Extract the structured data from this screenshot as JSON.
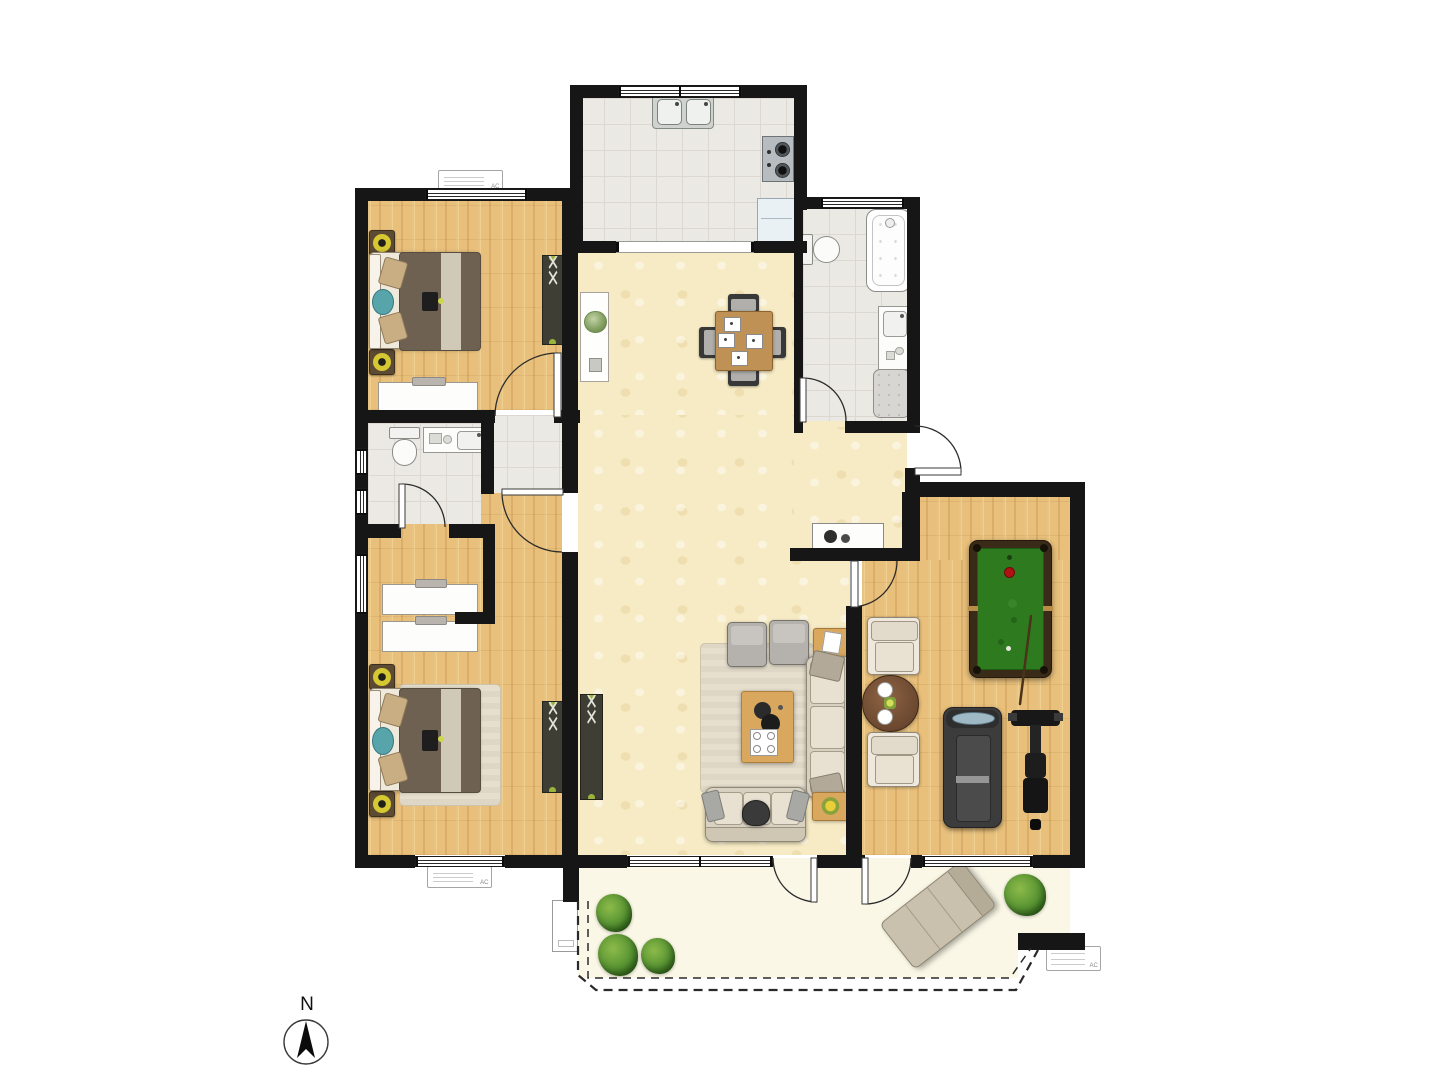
{
  "meta": {
    "title": "apartment-floor-plan",
    "ac_label": "AC"
  },
  "compass": {
    "label": "N",
    "cx": 306,
    "cy": 1042,
    "r": 22,
    "arrow": "306,1021 315,1058 306,1049 297,1058"
  },
  "palette": {
    "wall": "#161616",
    "wood": "#e9c07b",
    "tile": "#ebe9e4",
    "tileline": "#dcd8d1",
    "hall": "#f6ebc4",
    "balcony": "#faf7e6",
    "felt": "#2e7b1f",
    "plant_green": "#569331",
    "accent_teal": "#57a4ab",
    "lamp_yellow": "#d6c832"
  },
  "rooms": [
    {
      "name": "kitchen"
    },
    {
      "name": "bathroom-main"
    },
    {
      "name": "bedroom-guest"
    },
    {
      "name": "bathroom-small"
    },
    {
      "name": "bedroom-master"
    },
    {
      "name": "dining-living-hall"
    },
    {
      "name": "recreation-room"
    },
    {
      "name": "balcony"
    }
  ],
  "floors": [
    {
      "n": "balcony-floor",
      "c": "balcony",
      "x": 578,
      "y": 858,
      "w": 492,
      "h": 78
    },
    {
      "n": "balcony-floor",
      "c": "balcony",
      "x": 578,
      "y": 858,
      "w": 440,
      "h": 120
    },
    {
      "n": "dining-floor",
      "c": "hall",
      "x": 578,
      "y": 247,
      "w": 216,
      "h": 180
    },
    {
      "n": "hall-floor",
      "c": "hall",
      "x": 578,
      "y": 415,
      "w": 272,
      "h": 440
    },
    {
      "n": "entry-floor",
      "c": "hall",
      "x": 794,
      "y": 427,
      "w": 113,
      "h": 121
    },
    {
      "n": "bedroom-guest-floor",
      "c": "wood",
      "x": 368,
      "y": 201,
      "w": 194,
      "h": 209
    },
    {
      "n": "bedroom-master-floor",
      "c": "wood",
      "x": 368,
      "y": 490,
      "w": 194,
      "h": 365
    },
    {
      "n": "rec-room-floor",
      "c": "wood",
      "x": 915,
      "y": 495,
      "w": 155,
      "h": 75
    },
    {
      "n": "rec-room-floor",
      "c": "wood",
      "x": 862,
      "y": 560,
      "w": 208,
      "h": 295
    },
    {
      "n": "kitchen-floor",
      "c": "tile",
      "x": 578,
      "y": 98,
      "w": 216,
      "h": 143
    },
    {
      "n": "bathroom-floor",
      "c": "tile",
      "x": 803,
      "y": 208,
      "w": 104,
      "h": 213
    },
    {
      "n": "small-bath-floor",
      "c": "tile",
      "x": 368,
      "y": 423,
      "w": 113,
      "h": 101
    },
    {
      "n": "vestibule-floor",
      "c": "tile",
      "x": 481,
      "y": 415,
      "w": 81,
      "h": 78
    }
  ],
  "walls": [
    [
      570,
      85,
      237,
      13
    ],
    [
      570,
      85,
      13,
      168
    ],
    [
      794,
      85,
      13,
      125
    ],
    [
      794,
      197,
      126,
      12
    ],
    [
      907,
      197,
      13,
      236
    ],
    [
      794,
      209,
      9,
      224
    ],
    [
      845,
      421,
      75,
      12
    ],
    [
      570,
      241,
      46,
      12
    ],
    [
      754,
      241,
      53,
      12
    ],
    [
      355,
      188,
      216,
      13
    ],
    [
      355,
      188,
      13,
      680
    ],
    [
      355,
      410,
      140,
      13
    ],
    [
      562,
      188,
      16,
      305
    ],
    [
      554,
      410,
      26,
      13
    ],
    [
      481,
      410,
      13,
      84
    ],
    [
      355,
      524,
      46,
      14
    ],
    [
      449,
      524,
      46,
      14
    ],
    [
      483,
      538,
      12,
      86
    ],
    [
      455,
      612,
      40,
      12
    ],
    [
      562,
      552,
      16,
      306
    ],
    [
      790,
      548,
      125,
      13
    ],
    [
      902,
      492,
      18,
      69
    ],
    [
      846,
      606,
      16,
      252
    ],
    [
      906,
      482,
      179,
      15
    ],
    [
      905,
      468,
      15,
      28
    ],
    [
      1070,
      482,
      15,
      386
    ],
    [
      355,
      855,
      60,
      13
    ],
    [
      505,
      855,
      58,
      13
    ],
    [
      563,
      855,
      16,
      47
    ],
    [
      563,
      855,
      64,
      13
    ],
    [
      817,
      855,
      48,
      13
    ],
    [
      911,
      855,
      11,
      13
    ],
    [
      1033,
      855,
      52,
      13
    ],
    [
      1018,
      933,
      67,
      17
    ]
  ],
  "windows": [
    {
      "x": 618,
      "y": 86,
      "w": 124,
      "h": 11,
      "o": "h"
    },
    {
      "x": 820,
      "y": 198,
      "w": 85,
      "h": 10,
      "o": "h"
    },
    {
      "x": 425,
      "y": 189,
      "w": 103,
      "h": 11,
      "o": "h"
    },
    {
      "x": 356,
      "y": 448,
      "w": 11,
      "h": 28,
      "o": "v"
    },
    {
      "x": 356,
      "y": 488,
      "w": 11,
      "h": 28,
      "o": "v"
    },
    {
      "x": 356,
      "y": 553,
      "w": 11,
      "h": 62,
      "o": "v"
    },
    {
      "x": 415,
      "y": 856,
      "w": 90,
      "h": 11,
      "o": "h"
    },
    {
      "x": 627,
      "y": 856,
      "w": 146,
      "h": 11,
      "o": "h"
    },
    {
      "x": 922,
      "y": 856,
      "w": 111,
      "h": 11,
      "o": "h"
    }
  ],
  "openings": [
    {
      "n": "kitchen-pass-opening",
      "x": 616,
      "y": 241,
      "w": 138,
      "h": 12
    }
  ],
  "doors": [
    {
      "n": "door-bedroom-guest",
      "p": "M495,416 A63 63 0 0 1 558,353",
      "leaf": [
        554,
        353,
        7,
        64
      ]
    },
    {
      "n": "door-small-bath",
      "p": "M402,484 A43 43 0 0 1 445,527",
      "leaf": [
        399,
        484,
        6,
        44
      ]
    },
    {
      "n": "door-bedroom-master",
      "p": "M502,492 A60 60 0 0 0 562,552",
      "leaf": [
        502,
        489,
        61,
        6
      ]
    },
    {
      "n": "door-bathroom-main",
      "p": "M803,378 A43 43 0 0 1 846,421",
      "leaf": [
        800,
        378,
        6,
        44
      ]
    },
    {
      "n": "door-rec-room",
      "p": "M897,561 A46 46 0 0 1 851,607",
      "leaf": [
        851,
        561,
        7,
        46
      ]
    },
    {
      "n": "door-entry",
      "p": "M961,472 A46 46 0 0 0 915,426",
      "leaf": [
        915,
        468,
        46,
        7
      ]
    },
    {
      "n": "door-balcony-living",
      "p": "M817,902 A44 44 0 0 1 773,858",
      "leaf": [
        811,
        858,
        6,
        44
      ]
    },
    {
      "n": "door-balcony-rec",
      "p": "M865,904 A46 46 0 0 0 911,858",
      "leaf": [
        862,
        858,
        6,
        46
      ]
    }
  ],
  "railing": {
    "outer": "M578,901 L578,975 L596,990 L1016,990 L1038,950",
    "inner": "M588,901 L588,978 L1010,978 L1031,948"
  },
  "cue_stick": "M1031,616 L1020,704",
  "furniture": [
    {
      "t": "sink2",
      "n": "kitchen-double-sink",
      "x": 652,
      "y": 94,
      "w": 60,
      "h": 33
    },
    {
      "t": "cooktop",
      "n": "cooktop",
      "x": 762,
      "y": 136,
      "w": 30,
      "h": 44
    },
    {
      "t": "fridge",
      "n": "refrigerator",
      "x": 757,
      "y": 198,
      "w": 37,
      "h": 42
    },
    {
      "t": "tub",
      "n": "bathtub",
      "x": 866,
      "y": 209,
      "w": 43,
      "h": 81
    },
    {
      "t": "toileth",
      "n": "toilet-main",
      "x": 802,
      "y": 234,
      "w": 38,
      "h": 29
    },
    {
      "t": "vanityv",
      "n": "bathroom-vanity",
      "x": 878,
      "y": 306,
      "w": 30,
      "h": 62
    },
    {
      "t": "showertray",
      "n": "shower-tray",
      "x": 873,
      "y": 369,
      "w": 35,
      "h": 47
    },
    {
      "t": "lamp",
      "n": "nightstand-lamp",
      "x": 369,
      "y": 230,
      "w": 24,
      "h": 24
    },
    {
      "t": "lamp",
      "n": "nightstand-lamp",
      "x": 369,
      "y": 349,
      "w": 24,
      "h": 24
    },
    {
      "t": "bedh",
      "n": "bed-guest",
      "x": 369,
      "y": 252,
      "w": 110,
      "h": 97
    },
    {
      "t": "desk",
      "n": "desk-guest",
      "x": 378,
      "y": 382,
      "w": 100,
      "h": 31
    },
    {
      "t": "wardrobe",
      "n": "wardrobe-guest",
      "x": 542,
      "y": 255,
      "w": 20,
      "h": 88
    },
    {
      "t": "console",
      "n": "hall-console",
      "x": 580,
      "y": 292,
      "w": 27,
      "h": 88
    },
    {
      "t": "chair",
      "n": "dining-chair",
      "x": 728,
      "y": 294,
      "w": 31,
      "h": 19,
      "d": "n"
    },
    {
      "t": "chair",
      "n": "dining-chair",
      "x": 728,
      "y": 367,
      "w": 31,
      "h": 19,
      "d": "s"
    },
    {
      "t": "chair",
      "n": "dining-chair",
      "x": 699,
      "y": 327,
      "w": 19,
      "h": 31,
      "d": "w"
    },
    {
      "t": "chair",
      "n": "dining-chair",
      "x": 767,
      "y": 327,
      "w": 19,
      "h": 31,
      "d": "e"
    },
    {
      "t": "tableD",
      "n": "dining-table",
      "x": 715,
      "y": 311,
      "w": 56,
      "h": 58
    },
    {
      "t": "toiletv",
      "n": "toilet-small",
      "x": 389,
      "y": 427,
      "w": 29,
      "h": 39
    },
    {
      "t": "vanityh",
      "n": "small-bath-vanity",
      "x": 423,
      "y": 427,
      "w": 63,
      "h": 24
    },
    {
      "t": "desk",
      "n": "desk-master",
      "x": 382,
      "y": 584,
      "w": 96,
      "h": 31
    },
    {
      "t": "desk",
      "n": "desk-master",
      "x": 382,
      "y": 621,
      "w": 96,
      "h": 31
    },
    {
      "t": "rug",
      "n": "bedside-rug",
      "x": 399,
      "y": 684,
      "w": 100,
      "h": 120
    },
    {
      "t": "lamp",
      "n": "nightstand-lamp",
      "x": 369,
      "y": 664,
      "w": 24,
      "h": 24
    },
    {
      "t": "lamp",
      "n": "nightstand-lamp",
      "x": 369,
      "y": 791,
      "w": 24,
      "h": 24
    },
    {
      "t": "bedh",
      "n": "bed-master",
      "x": 369,
      "y": 688,
      "w": 110,
      "h": 103
    },
    {
      "t": "wardrobe",
      "n": "wardrobe-master",
      "x": 542,
      "y": 701,
      "w": 20,
      "h": 90
    },
    {
      "t": "wardrobe",
      "n": "hall-wardrobe",
      "x": 580,
      "y": 694,
      "w": 21,
      "h": 104
    },
    {
      "t": "shoecab",
      "n": "shoe-cabinet",
      "x": 812,
      "y": 523,
      "w": 70,
      "h": 26
    },
    {
      "t": "rug",
      "n": "living-rug",
      "x": 700,
      "y": 643,
      "w": 112,
      "h": 148
    },
    {
      "t": "ottoman",
      "n": "ottoman",
      "x": 727,
      "y": 622,
      "w": 38,
      "h": 43
    },
    {
      "t": "ottoman",
      "n": "ottoman",
      "x": 769,
      "y": 620,
      "w": 38,
      "h": 43
    },
    {
      "t": "sidetable",
      "n": "side-table",
      "x": 813,
      "y": 628,
      "w": 35,
      "h": 27,
      "item": "book"
    },
    {
      "t": "sofav",
      "n": "sofa-main",
      "x": 806,
      "y": 656,
      "w": 48,
      "h": 140
    },
    {
      "t": "coffee",
      "n": "coffee-table",
      "x": 741,
      "y": 691,
      "w": 51,
      "h": 70
    },
    {
      "t": "sofah",
      "n": "sofa-small",
      "x": 705,
      "y": 787,
      "w": 99,
      "h": 53
    },
    {
      "t": "pouf",
      "n": "footstool",
      "x": 742,
      "y": 800,
      "w": 26,
      "h": 24
    },
    {
      "t": "sidetable",
      "n": "side-table",
      "x": 812,
      "y": 792,
      "w": 35,
      "h": 27,
      "item": "flower"
    },
    {
      "t": "pool",
      "n": "pool-table",
      "x": 969,
      "y": 540,
      "w": 81,
      "h": 136
    },
    {
      "t": "armchair",
      "n": "armchair",
      "x": 867,
      "y": 617,
      "w": 51,
      "h": 56
    },
    {
      "t": "roundtable",
      "n": "tea-table",
      "x": 862,
      "y": 675,
      "w": 55,
      "h": 55
    },
    {
      "t": "armchair",
      "n": "armchair",
      "x": 867,
      "y": 732,
      "w": 51,
      "h": 53
    },
    {
      "t": "treadmill",
      "n": "treadmill",
      "x": 943,
      "y": 707,
      "w": 57,
      "h": 119
    },
    {
      "t": "bike",
      "n": "exercise-bike",
      "x": 1011,
      "y": 706,
      "w": 49,
      "h": 124
    },
    {
      "t": "plant",
      "n": "balcony-plant",
      "x": 596,
      "y": 894,
      "w": 36,
      "h": 38
    },
    {
      "t": "plant",
      "n": "balcony-plant",
      "x": 598,
      "y": 934,
      "w": 40,
      "h": 42
    },
    {
      "t": "plant",
      "n": "balcony-plant",
      "x": 641,
      "y": 938,
      "w": 34,
      "h": 36
    },
    {
      "t": "plant",
      "n": "balcony-plant",
      "x": 1004,
      "y": 874,
      "w": 42,
      "h": 42
    },
    {
      "t": "lounger",
      "n": "lounge-chair",
      "x": 886,
      "y": 886,
      "w": 102,
      "h": 56,
      "rot": -38
    },
    {
      "t": "panel",
      "n": "utility-unit",
      "x": 552,
      "y": 900,
      "w": 24,
      "h": 50
    },
    {
      "t": "ac",
      "n": "ac-unit",
      "x": 438,
      "y": 170,
      "w": 63,
      "h": 20
    },
    {
      "t": "ac",
      "n": "ac-unit",
      "x": 427,
      "y": 866,
      "w": 63,
      "h": 20
    },
    {
      "t": "ac",
      "n": "ac-unit",
      "x": 1046,
      "y": 946,
      "w": 53,
      "h": 23
    }
  ]
}
